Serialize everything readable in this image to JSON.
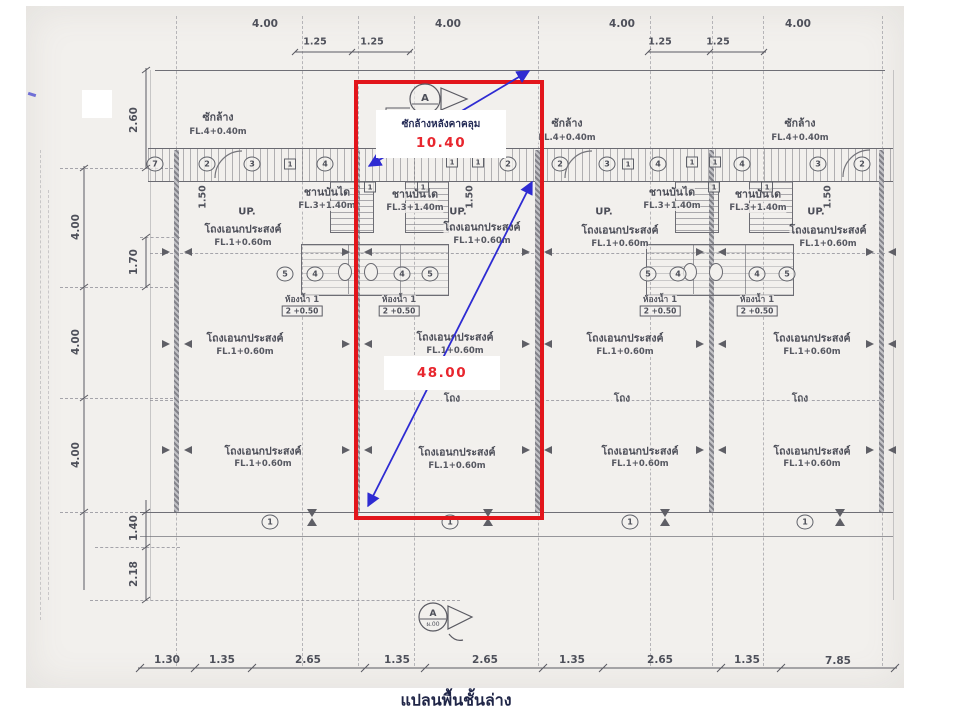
{
  "page": {
    "caption": "แปลนพื้นชั้นล่าง"
  },
  "overlay": {
    "roof_label": "ซักล้างหลังคาคลุม",
    "width_value": "10.40",
    "height_value": "48.00"
  },
  "dims": {
    "top_main": [
      "4.00",
      "4.00",
      "4.00",
      "4.00"
    ],
    "top_sub": [
      "1.25",
      "1.25",
      "1.25",
      "1.25"
    ],
    "left_outer": [
      "4.00",
      "4.00",
      "4.00"
    ],
    "left_inner": [
      "2.60",
      "1.70",
      "1.40",
      "2.18"
    ],
    "bottom": [
      "1.30",
      "1.35",
      "2.65",
      "1.35",
      "2.65",
      "1.35",
      "2.65",
      "1.35",
      "7.85"
    ],
    "stair_width": "1.50"
  },
  "rooms": {
    "laundry": {
      "name": "ซักล้าง",
      "level": "FL.4+0.40m"
    },
    "stair_landing": {
      "name": "ชานบันได",
      "level": "FL.3+1.40m"
    },
    "multipurpose": {
      "name": "โถงเอนกประสงค์",
      "level": "FL.1+0.60m"
    },
    "hall": "โถง",
    "bathroom": {
      "name": "ห้องน้ำ 1",
      "level": "2 +0.50"
    },
    "up": "UP."
  },
  "tags": {
    "n1": "1",
    "n2": "2",
    "n3": "3",
    "n4": "4",
    "n5": "5",
    "n7": "7"
  },
  "section": {
    "letter": "A",
    "sheet": "ผ.00"
  },
  "colors": {
    "highlight_red": "#e2151b",
    "annotation_blue": "#2e2bd2",
    "label_navy": "#232a55"
  }
}
